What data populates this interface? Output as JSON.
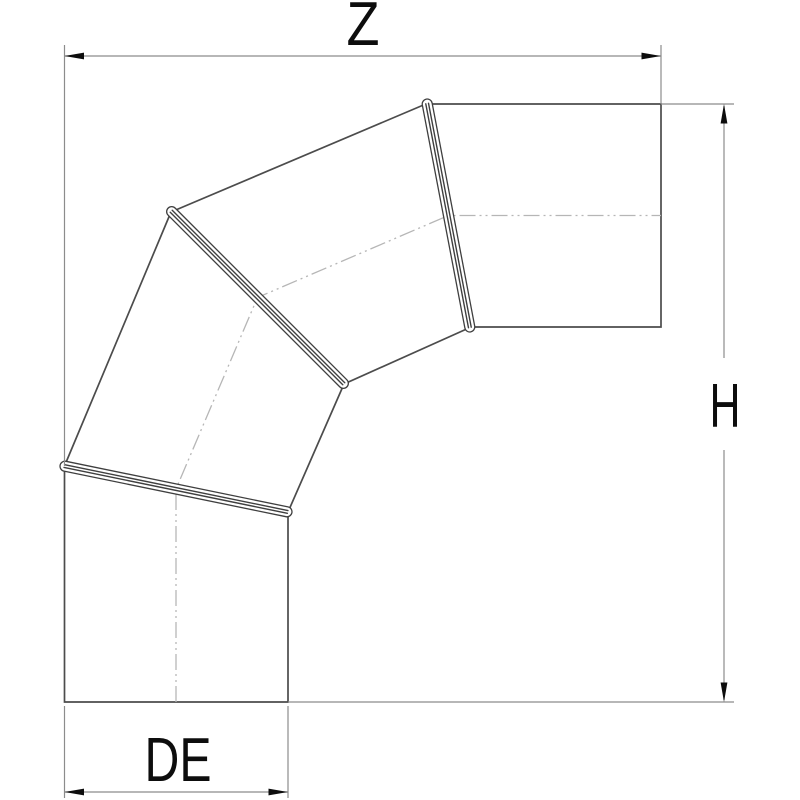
{
  "drawing": {
    "description": "Segmented 90-degree pipe elbow, side view with three crimped seam joints",
    "dimensions": {
      "width_label": "Z",
      "height_label": "H",
      "diameter_label": "DE"
    }
  },
  "colors": {
    "background": "#ffffff",
    "outline": "#4c4c4c",
    "seam": "#3f3f3f",
    "dimension_line": "#8c8c8c",
    "centerline": "#b6b6b6",
    "label": "#0d0d0d"
  }
}
